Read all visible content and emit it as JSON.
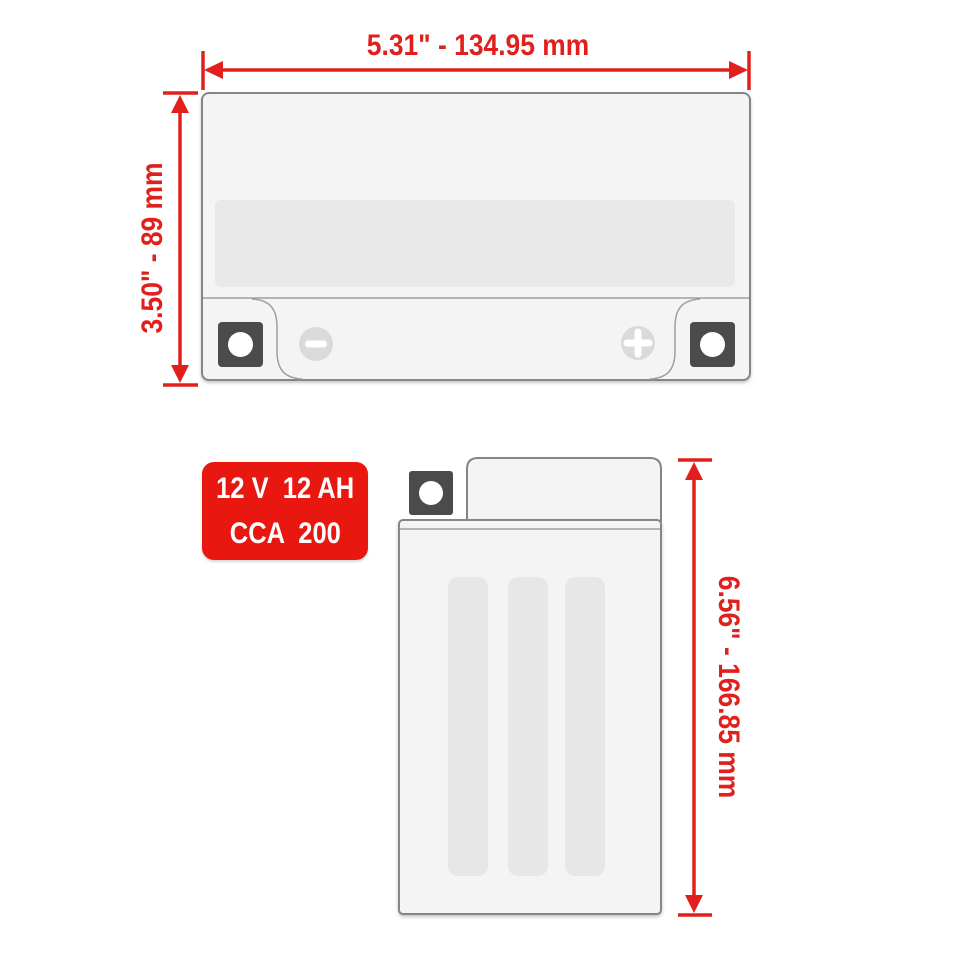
{
  "colors": {
    "dimension-red": "#e1201d",
    "badge-red": "#e8170f",
    "terminal-dark": "#4b4b4b"
  },
  "top_view": {
    "width_label": "5.31\" - 134.95 mm",
    "height_label": "3.50\" - 89 mm",
    "negative_symbol": "minus",
    "positive_symbol": "plus"
  },
  "side_view": {
    "height_label": "6.56\" - 166.85 mm"
  },
  "badge": {
    "line1": "12 V  12 AH",
    "line2": "CCA  200"
  }
}
